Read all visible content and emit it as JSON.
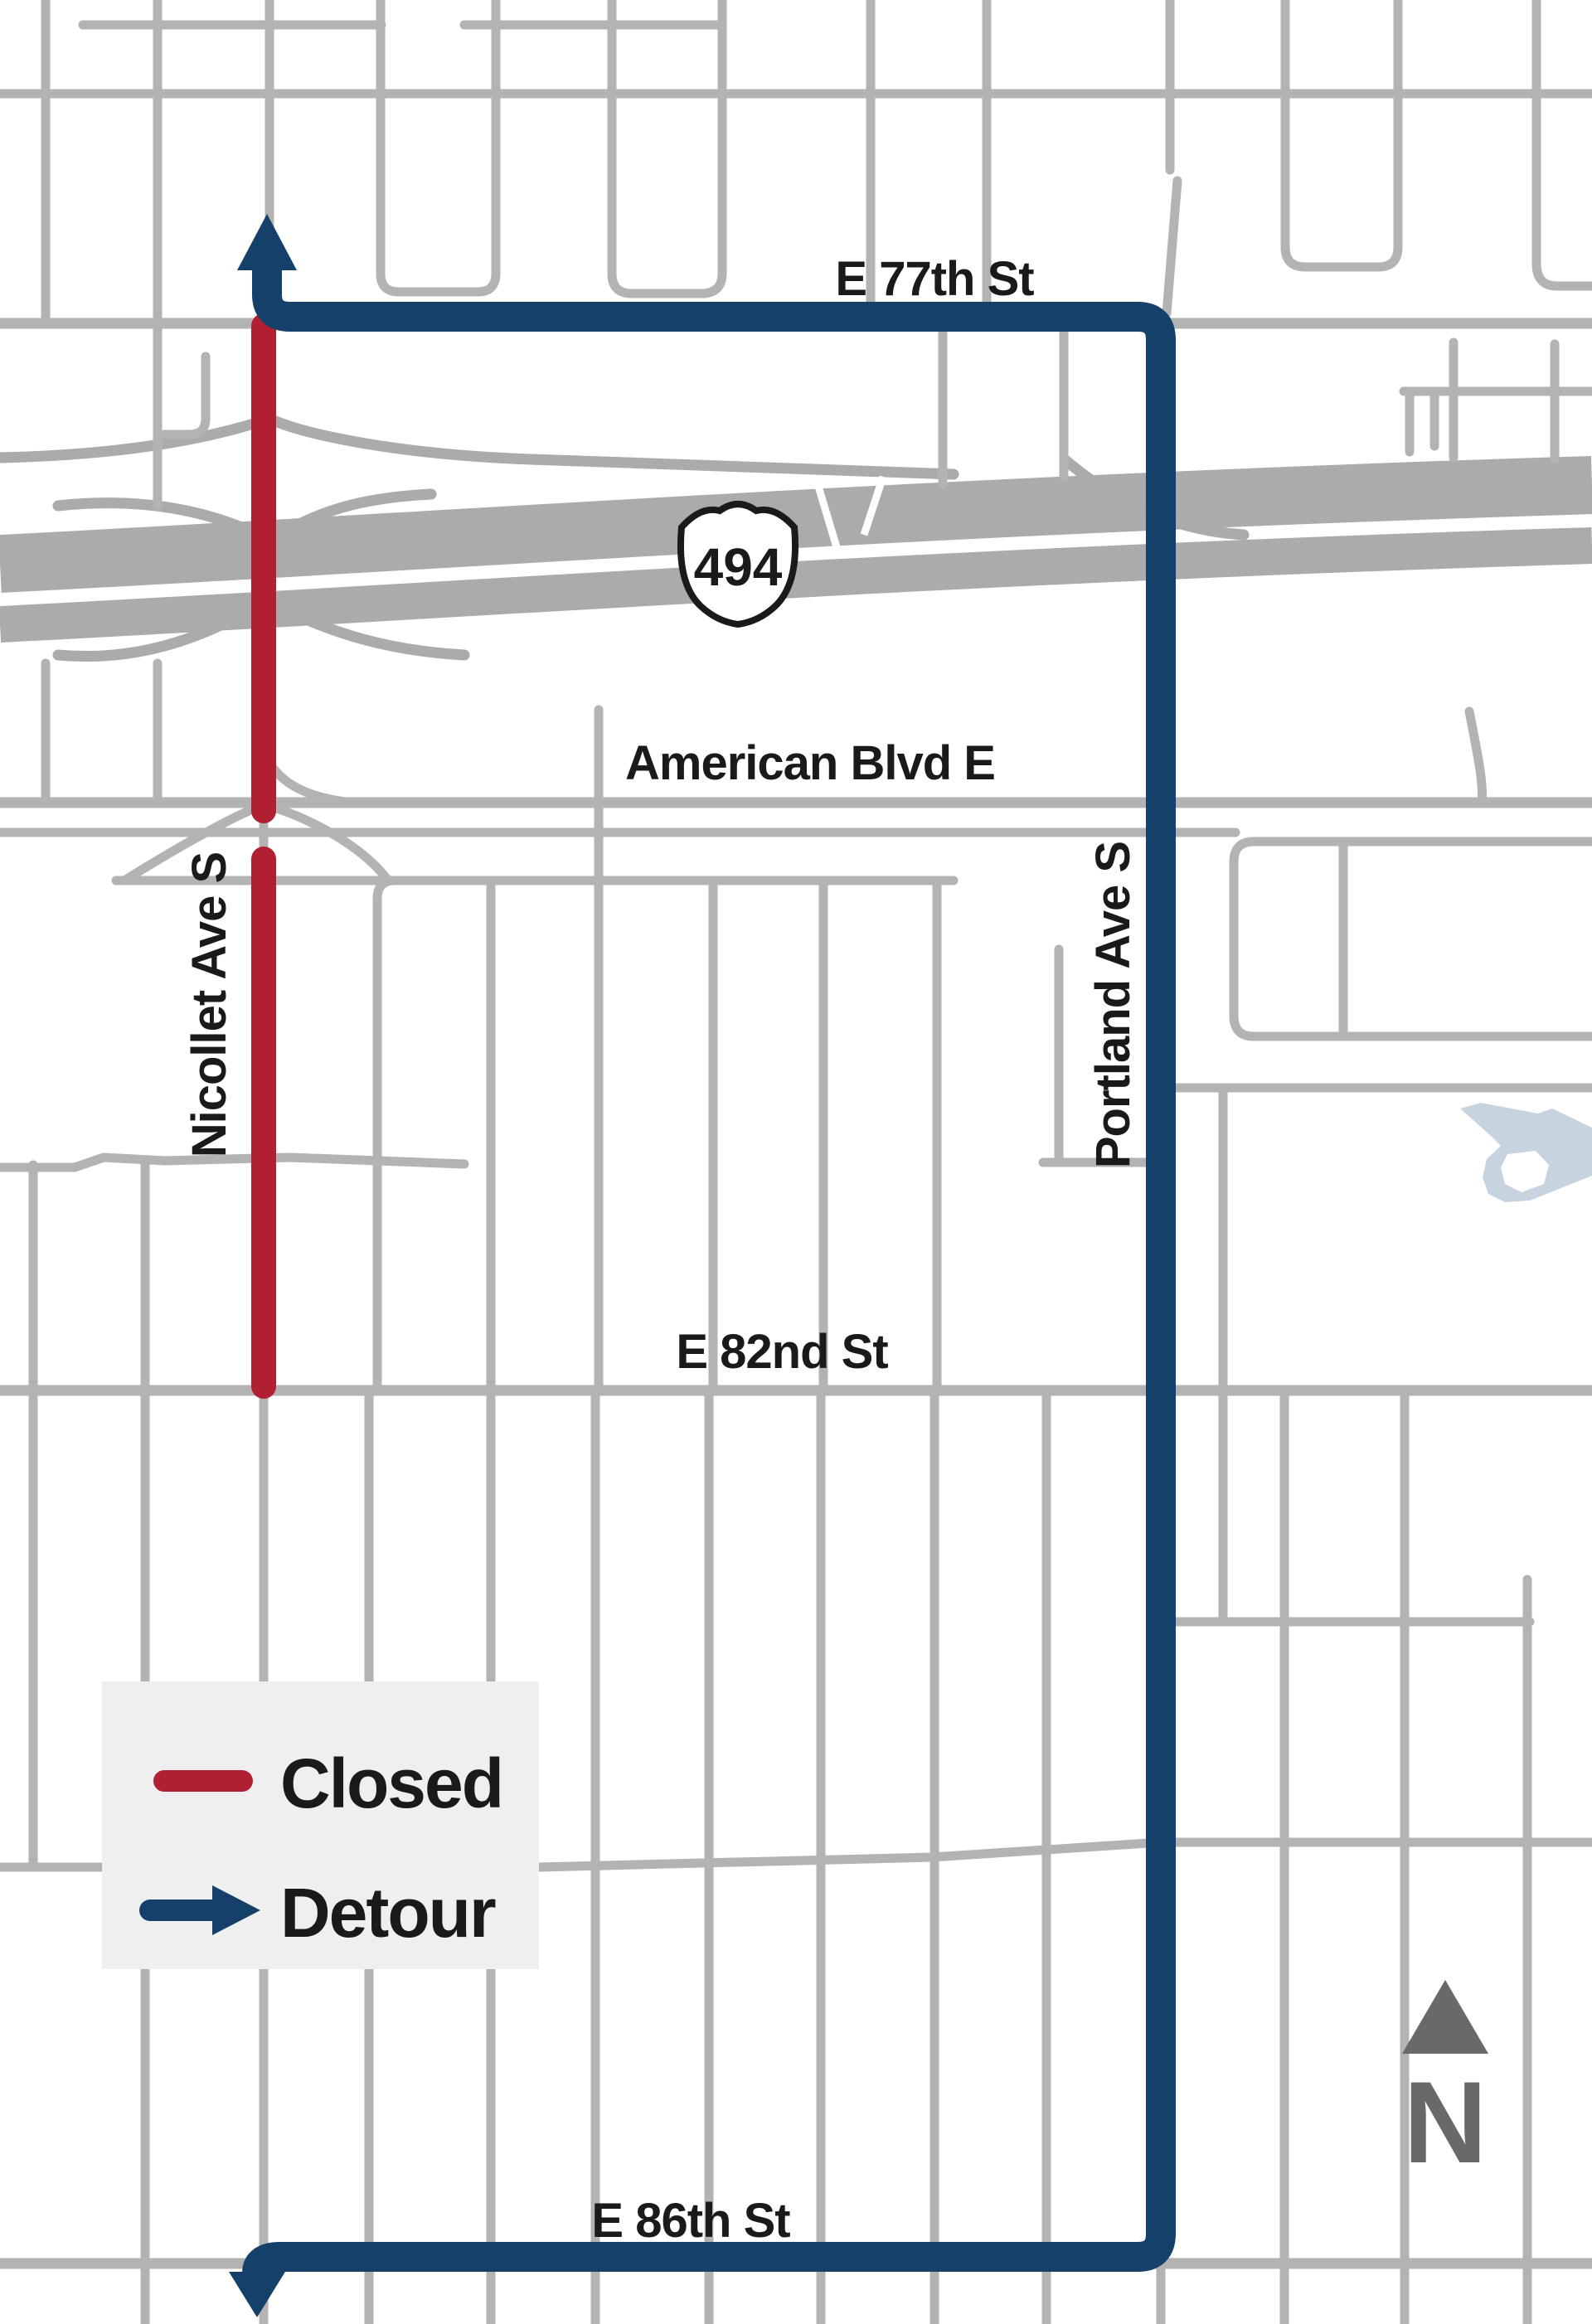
{
  "colors": {
    "background": "#ffffff",
    "road": "#b3b3b3",
    "freeway": "#ababab",
    "closed": "#b11f33",
    "detour": "#14406a",
    "water": "#c8d3e0",
    "legend_bg": "#efefef",
    "north": "#696969",
    "label": "#1a1a1a"
  },
  "map": {
    "street_labels": {
      "e77th": "E 77th St",
      "american": "American Blvd E",
      "e82nd": "E 82nd St",
      "e86th": "E 86th St",
      "nicollet": "Nicollet Ave S",
      "portland": "Portland Ave S"
    },
    "highway_shield": {
      "number": "494"
    },
    "compass": {
      "label": "N"
    }
  },
  "legend": {
    "closed_label": "Closed",
    "detour_label": "Detour"
  }
}
